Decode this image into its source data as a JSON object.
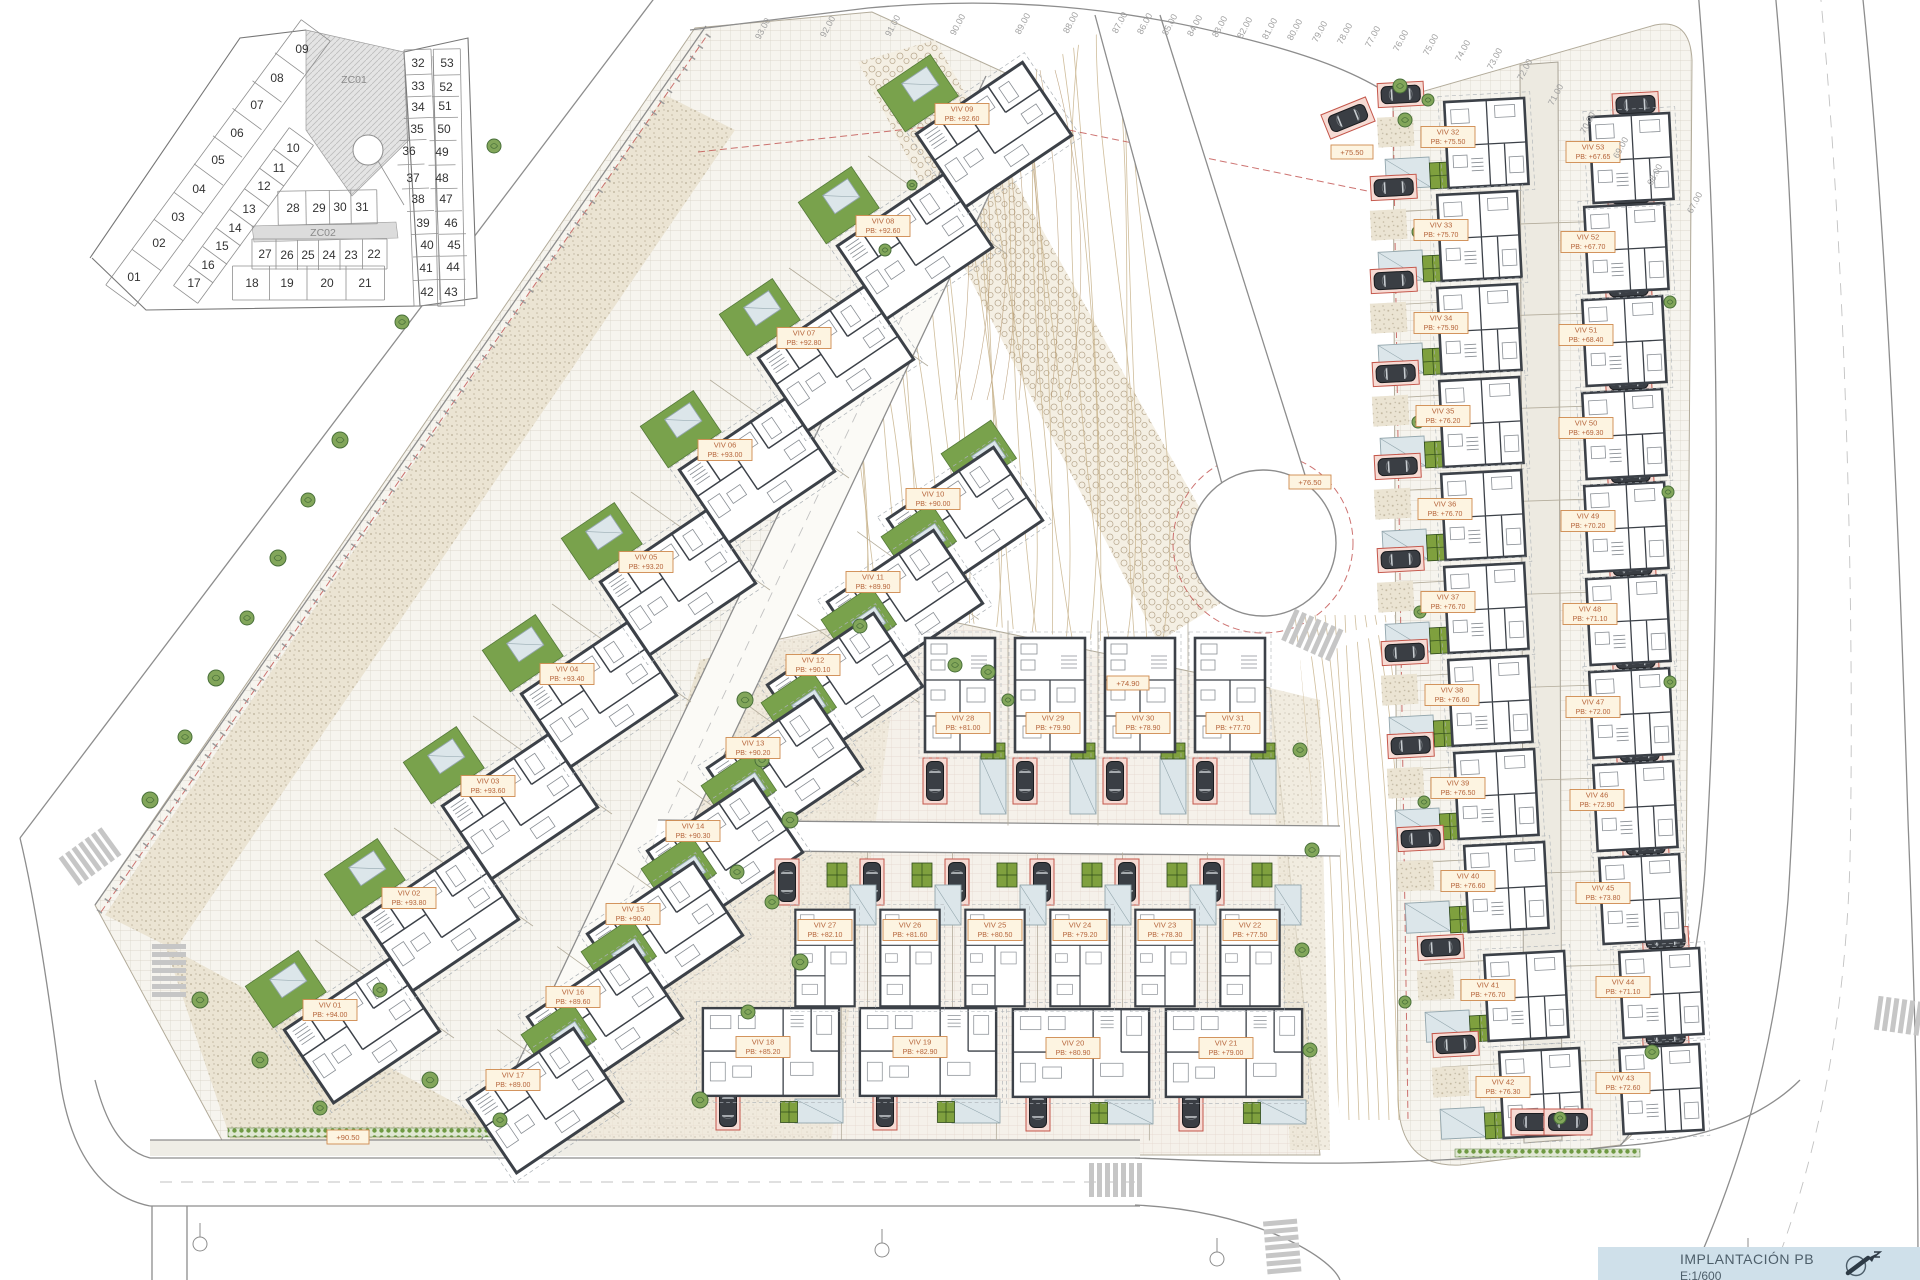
{
  "title_block": {
    "title": "IMPLANTACIÓN PB",
    "scale": "E:1/600"
  },
  "keyplan": {
    "zones": [
      {
        "label": "ZC01",
        "x": 354,
        "y": 83
      },
      {
        "label": "ZC02",
        "x": 323,
        "y": 236
      }
    ],
    "plots": [
      {
        "n": "01",
        "x": 134,
        "y": 281
      },
      {
        "n": "02",
        "x": 159,
        "y": 247
      },
      {
        "n": "03",
        "x": 178,
        "y": 221
      },
      {
        "n": "04",
        "x": 199,
        "y": 193
      },
      {
        "n": "05",
        "x": 218,
        "y": 164
      },
      {
        "n": "06",
        "x": 237,
        "y": 137
      },
      {
        "n": "07",
        "x": 257,
        "y": 109
      },
      {
        "n": "08",
        "x": 277,
        "y": 82
      },
      {
        "n": "09",
        "x": 302,
        "y": 53
      },
      {
        "n": "10",
        "x": 293,
        "y": 152
      },
      {
        "n": "11",
        "x": 279,
        "y": 172
      },
      {
        "n": "12",
        "x": 264,
        "y": 190
      },
      {
        "n": "13",
        "x": 249,
        "y": 213
      },
      {
        "n": "14",
        "x": 235,
        "y": 232
      },
      {
        "n": "15",
        "x": 222,
        "y": 250
      },
      {
        "n": "16",
        "x": 208,
        "y": 269
      },
      {
        "n": "17",
        "x": 194,
        "y": 287
      },
      {
        "n": "18",
        "x": 252,
        "y": 287
      },
      {
        "n": "19",
        "x": 287,
        "y": 287
      },
      {
        "n": "20",
        "x": 327,
        "y": 287
      },
      {
        "n": "21",
        "x": 365,
        "y": 287
      },
      {
        "n": "22",
        "x": 374,
        "y": 258
      },
      {
        "n": "23",
        "x": 351,
        "y": 259
      },
      {
        "n": "24",
        "x": 329,
        "y": 259
      },
      {
        "n": "25",
        "x": 308,
        "y": 259
      },
      {
        "n": "26",
        "x": 287,
        "y": 259
      },
      {
        "n": "27",
        "x": 265,
        "y": 258
      },
      {
        "n": "28",
        "x": 293,
        "y": 212
      },
      {
        "n": "29",
        "x": 319,
        "y": 212
      },
      {
        "n": "30",
        "x": 340,
        "y": 211
      },
      {
        "n": "31",
        "x": 362,
        "y": 211
      },
      {
        "n": "32",
        "x": 418,
        "y": 67
      },
      {
        "n": "33",
        "x": 418,
        "y": 90
      },
      {
        "n": "34",
        "x": 418,
        "y": 111
      },
      {
        "n": "35",
        "x": 417,
        "y": 133
      },
      {
        "n": "36",
        "x": 409,
        "y": 155
      },
      {
        "n": "37",
        "x": 413,
        "y": 182
      },
      {
        "n": "38",
        "x": 418,
        "y": 203
      },
      {
        "n": "39",
        "x": 423,
        "y": 227
      },
      {
        "n": "40",
        "x": 427,
        "y": 249
      },
      {
        "n": "41",
        "x": 426,
        "y": 272
      },
      {
        "n": "42",
        "x": 427,
        "y": 296
      },
      {
        "n": "43",
        "x": 451,
        "y": 296
      },
      {
        "n": "44",
        "x": 453,
        "y": 271
      },
      {
        "n": "45",
        "x": 454,
        "y": 249
      },
      {
        "n": "46",
        "x": 451,
        "y": 227
      },
      {
        "n": "47",
        "x": 446,
        "y": 203
      },
      {
        "n": "48",
        "x": 442,
        "y": 182
      },
      {
        "n": "49",
        "x": 442,
        "y": 156
      },
      {
        "n": "50",
        "x": 444,
        "y": 133
      },
      {
        "n": "51",
        "x": 445,
        "y": 110
      },
      {
        "n": "52",
        "x": 446,
        "y": 91
      },
      {
        "n": "53",
        "x": 447,
        "y": 67
      }
    ],
    "strips": [
      {
        "nums": [
          "01",
          "02",
          "03",
          "04",
          "05",
          "06",
          "07",
          "08",
          "09"
        ],
        "w": 36
      },
      {
        "nums": [
          "10",
          "11",
          "12",
          "13",
          "14",
          "15",
          "16",
          "17"
        ],
        "w": 30
      },
      {
        "nums": [
          "18",
          "19",
          "20",
          "21"
        ],
        "w": 34
      },
      {
        "nums": [
          "27",
          "26",
          "25",
          "24",
          "23",
          "22"
        ],
        "w": 30
      },
      {
        "nums": [
          "28",
          "29",
          "30",
          "31"
        ],
        "w": 34
      },
      {
        "nums": [
          "32",
          "33",
          "34",
          "35",
          "36",
          "37",
          "38",
          "39",
          "40",
          "41",
          "42"
        ],
        "w": 27
      },
      {
        "nums": [
          "53",
          "52",
          "51",
          "50",
          "49",
          "48",
          "47",
          "46",
          "45",
          "44",
          "43"
        ],
        "w": 27
      }
    ]
  },
  "site": {
    "villas": [
      {
        "id": "VIV 01",
        "pb": "PB: +94.00",
        "x": 330,
        "y": 1010,
        "t": "A"
      },
      {
        "id": "VIV 02",
        "pb": "PB: +93.80",
        "x": 409,
        "y": 898,
        "t": "A"
      },
      {
        "id": "VIV 03",
        "pb": "PB: +93.60",
        "x": 488,
        "y": 786,
        "t": "A"
      },
      {
        "id": "VIV 04",
        "pb": "PB: +93.40",
        "x": 567,
        "y": 674,
        "t": "A"
      },
      {
        "id": "VIV 05",
        "pb": "PB: +93.20",
        "x": 646,
        "y": 562,
        "t": "A"
      },
      {
        "id": "VIV 06",
        "pb": "PB: +93.00",
        "x": 725,
        "y": 450,
        "t": "A"
      },
      {
        "id": "VIV 07",
        "pb": "PB: +92.80",
        "x": 804,
        "y": 338,
        "t": "A"
      },
      {
        "id": "VIV 08",
        "pb": "PB: +92.60",
        "x": 883,
        "y": 226,
        "t": "A"
      },
      {
        "id": "VIV 09",
        "pb": "PB: +92.60",
        "x": 962,
        "y": 114,
        "t": "A"
      },
      {
        "id": "VIV 10",
        "pb": "PB: +90.00",
        "x": 933,
        "y": 499,
        "t": "A2"
      },
      {
        "id": "VIV 11",
        "pb": "PB: +89.90",
        "x": 873,
        "y": 582,
        "t": "A2"
      },
      {
        "id": "VIV 12",
        "pb": "PB: +90.10",
        "x": 813,
        "y": 665,
        "t": "A2"
      },
      {
        "id": "VIV 13",
        "pb": "PB: +90.20",
        "x": 753,
        "y": 748,
        "t": "A2"
      },
      {
        "id": "VIV 14",
        "pb": "PB: +90.30",
        "x": 693,
        "y": 831,
        "t": "A2"
      },
      {
        "id": "VIV 15",
        "pb": "PB: +90.40",
        "x": 633,
        "y": 914,
        "t": "A2"
      },
      {
        "id": "VIV 16",
        "pb": "PB: +89.60",
        "x": 573,
        "y": 997,
        "t": "A2"
      },
      {
        "id": "VIV 17",
        "pb": "PB: +89.00",
        "x": 513,
        "y": 1080,
        "t": "A2"
      },
      {
        "id": "VIV 18",
        "pb": "PB: +85.20",
        "x": 763,
        "y": 1047,
        "t": "D"
      },
      {
        "id": "VIV 19",
        "pb": "PB: +82.90",
        "x": 920,
        "y": 1047,
        "t": "D"
      },
      {
        "id": "VIV 20",
        "pb": "PB: +80.90",
        "x": 1073,
        "y": 1048,
        "t": "D"
      },
      {
        "id": "VIV 21",
        "pb": "PB: +79.00",
        "x": 1226,
        "y": 1048,
        "t": "D"
      },
      {
        "id": "VIV 22",
        "pb": "PB: +77.50",
        "x": 1250,
        "y": 930,
        "t": "B2"
      },
      {
        "id": "VIV 23",
        "pb": "PB: +78.30",
        "x": 1165,
        "y": 930,
        "t": "B2"
      },
      {
        "id": "VIV 24",
        "pb": "PB: +79.20",
        "x": 1080,
        "y": 930,
        "t": "B2"
      },
      {
        "id": "VIV 25",
        "pb": "PB: +80.50",
        "x": 995,
        "y": 930,
        "t": "B2"
      },
      {
        "id": "VIV 26",
        "pb": "PB: +81.60",
        "x": 910,
        "y": 930,
        "t": "B2"
      },
      {
        "id": "VIV 27",
        "pb": "PB: +82.10",
        "x": 825,
        "y": 930,
        "t": "B2"
      },
      {
        "id": "VIV 28",
        "pb": "PB: +81.00",
        "x": 963,
        "y": 723,
        "t": "B"
      },
      {
        "id": "VIV 29",
        "pb": "PB: +79.90",
        "x": 1053,
        "y": 723,
        "t": "B"
      },
      {
        "id": "VIV 30",
        "pb": "PB: +78.90",
        "x": 1143,
        "y": 723,
        "t": "B"
      },
      {
        "id": "VIV 31",
        "pb": "PB: +77.70",
        "x": 1233,
        "y": 723,
        "t": "B"
      },
      {
        "id": "VIV 32",
        "pb": "PB: +75.50",
        "x": 1448,
        "y": 137,
        "t": "C",
        "s": "L"
      },
      {
        "id": "VIV 33",
        "pb": "PB: +75.70",
        "x": 1441,
        "y": 230,
        "t": "C",
        "s": "L"
      },
      {
        "id": "VIV 34",
        "pb": "PB: +75.90",
        "x": 1441,
        "y": 323,
        "t": "C",
        "s": "L"
      },
      {
        "id": "VIV 35",
        "pb": "PB: +76.20",
        "x": 1443,
        "y": 416,
        "t": "C",
        "s": "L"
      },
      {
        "id": "VIV 36",
        "pb": "PB: +76.70",
        "x": 1445,
        "y": 509,
        "t": "C",
        "s": "L"
      },
      {
        "id": "VIV 37",
        "pb": "PB: +76.70",
        "x": 1448,
        "y": 602,
        "t": "C",
        "s": "L"
      },
      {
        "id": "VIV 38",
        "pb": "PB: +76.60",
        "x": 1452,
        "y": 695,
        "t": "C",
        "s": "L"
      },
      {
        "id": "VIV 39",
        "pb": "PB: +76.50",
        "x": 1458,
        "y": 788,
        "t": "C",
        "s": "L"
      },
      {
        "id": "VIV 40",
        "pb": "PB: +76.60",
        "x": 1468,
        "y": 881,
        "t": "C",
        "s": "L"
      },
      {
        "id": "VIV 41",
        "pb": "PB: +76.70",
        "x": 1488,
        "y": 990,
        "t": "C",
        "s": "L"
      },
      {
        "id": "VIV 42",
        "pb": "PB: +76.30",
        "x": 1503,
        "y": 1087,
        "t": "C",
        "s": "L"
      },
      {
        "id": "VIV 43",
        "pb": "PB: +72.60",
        "x": 1623,
        "y": 1083,
        "t": "C",
        "s": "R"
      },
      {
        "id": "VIV 44",
        "pb": "PB: +71.10",
        "x": 1623,
        "y": 987,
        "t": "C",
        "s": "R"
      },
      {
        "id": "VIV 45",
        "pb": "PB: +73.80",
        "x": 1603,
        "y": 893,
        "t": "C",
        "s": "R"
      },
      {
        "id": "VIV 46",
        "pb": "PB: +72.90",
        "x": 1597,
        "y": 800,
        "t": "C",
        "s": "R"
      },
      {
        "id": "VIV 47",
        "pb": "PB: +72.00",
        "x": 1593,
        "y": 707,
        "t": "C",
        "s": "R"
      },
      {
        "id": "VIV 48",
        "pb": "PB: +71.10",
        "x": 1590,
        "y": 614,
        "t": "C",
        "s": "R"
      },
      {
        "id": "VIV 49",
        "pb": "PB: +70.20",
        "x": 1588,
        "y": 521,
        "t": "C",
        "s": "R"
      },
      {
        "id": "VIV 50",
        "pb": "PB: +69.30",
        "x": 1586,
        "y": 428,
        "t": "C",
        "s": "R"
      },
      {
        "id": "VIV 51",
        "pb": "PB: +68.40",
        "x": 1586,
        "y": 335,
        "t": "C",
        "s": "R"
      },
      {
        "id": "VIV 52",
        "pb": "PB: +67.70",
        "x": 1588,
        "y": 242,
        "t": "C",
        "s": "R"
      },
      {
        "id": "VIV 53",
        "pb": "PB: +67.65",
        "x": 1593,
        "y": 152,
        "t": "C",
        "s": "R"
      }
    ],
    "spot_levels": [
      {
        "t": "+90.50",
        "x": 348,
        "y": 1137
      },
      {
        "t": "+76.50",
        "x": 1310,
        "y": 482
      },
      {
        "t": "+75.50",
        "x": 1352,
        "y": 152
      },
      {
        "t": "+74.90",
        "x": 1128,
        "y": 683
      }
    ],
    "elevation_labels": [
      {
        "t": "93.00",
        "x": 760,
        "y": 14
      },
      {
        "t": "92.00",
        "x": 825,
        "y": 12
      },
      {
        "t": "91.00",
        "x": 890,
        "y": 11
      },
      {
        "t": "90.00",
        "x": 955,
        "y": 10
      },
      {
        "t": "89.00",
        "x": 1020,
        "y": 9
      },
      {
        "t": "88.00",
        "x": 1068,
        "y": 8
      },
      {
        "t": "87.00",
        "x": 1117,
        "y": 8
      },
      {
        "t": "86.00",
        "x": 1142,
        "y": 9
      },
      {
        "t": "85.00",
        "x": 1167,
        "y": 10
      },
      {
        "t": "84.00",
        "x": 1192,
        "y": 11
      },
      {
        "t": "83.00",
        "x": 1217,
        "y": 12
      },
      {
        "t": "82.00",
        "x": 1242,
        "y": 13
      },
      {
        "t": "81.00",
        "x": 1267,
        "y": 14
      },
      {
        "t": "80.00",
        "x": 1292,
        "y": 15
      },
      {
        "t": "79.00",
        "x": 1317,
        "y": 17
      },
      {
        "t": "78.00",
        "x": 1342,
        "y": 19
      },
      {
        "t": "77.00",
        "x": 1370,
        "y": 22
      },
      {
        "t": "76.00",
        "x": 1398,
        "y": 26
      },
      {
        "t": "75.00",
        "x": 1428,
        "y": 30
      },
      {
        "t": "74.00",
        "x": 1460,
        "y": 36
      },
      {
        "t": "73.00",
        "x": 1492,
        "y": 44
      },
      {
        "t": "72.00",
        "x": 1522,
        "y": 55
      },
      {
        "t": "71.00",
        "x": 1553,
        "y": 80
      },
      {
        "t": "70.00",
        "x": 1585,
        "y": 108
      },
      {
        "t": "69.00",
        "x": 1618,
        "y": 133
      },
      {
        "t": "68.00",
        "x": 1652,
        "y": 160
      },
      {
        "t": "67.00",
        "x": 1692,
        "y": 188
      }
    ],
    "trees": [
      [
        150,
        800,
        8
      ],
      [
        185,
        737,
        7
      ],
      [
        216,
        678,
        8
      ],
      [
        247,
        618,
        7
      ],
      [
        278,
        558,
        8
      ],
      [
        308,
        500,
        7
      ],
      [
        340,
        440,
        8
      ],
      [
        402,
        322,
        7
      ],
      [
        432,
        262,
        8
      ],
      [
        494,
        146,
        7
      ],
      [
        200,
        1000,
        8
      ],
      [
        260,
        1060,
        8
      ],
      [
        320,
        1108,
        7
      ],
      [
        430,
        1080,
        8
      ],
      [
        500,
        1120,
        7
      ],
      [
        380,
        990,
        7
      ],
      [
        745,
        700,
        8
      ],
      [
        762,
        760,
        7
      ],
      [
        790,
        820,
        8
      ],
      [
        737,
        872,
        7
      ],
      [
        772,
        902,
        7
      ],
      [
        800,
        962,
        8
      ],
      [
        748,
        1012,
        7
      ],
      [
        700,
        1100,
        8
      ],
      [
        955,
        665,
        7
      ],
      [
        988,
        672,
        7
      ],
      [
        1008,
        700,
        6
      ],
      [
        860,
        626,
        7
      ],
      [
        1300,
        750,
        7
      ],
      [
        1312,
        850,
        7
      ],
      [
        1302,
        950,
        7
      ],
      [
        1310,
        1050,
        7
      ],
      [
        885,
        250,
        6
      ],
      [
        912,
        185,
        5
      ],
      [
        1405,
        120,
        7
      ],
      [
        1418,
        232,
        6
      ],
      [
        1418,
        422,
        6
      ],
      [
        1420,
        612,
        6
      ],
      [
        1424,
        802,
        6
      ],
      [
        1670,
        302,
        6
      ],
      [
        1668,
        492,
        6
      ],
      [
        1670,
        682,
        6
      ],
      [
        1405,
        1002,
        6
      ],
      [
        1652,
        1052,
        7
      ],
      [
        1560,
        1118,
        6
      ],
      [
        1400,
        86,
        7
      ],
      [
        1428,
        100,
        6
      ]
    ],
    "extra_cars": [
      [
        1535,
        1122,
        90
      ],
      [
        1568,
        1122,
        90
      ],
      [
        1348,
        118,
        68
      ]
    ],
    "crosswalks": [
      [
        88,
        858,
        -36
      ],
      [
        169,
        968,
        90
      ],
      [
        1113,
        1180,
        0
      ],
      [
        1310,
        634,
        24
      ],
      [
        1282,
        1244,
        85
      ],
      [
        1900,
        1016,
        8
      ]
    ],
    "hedges": [
      [
        228,
        1128,
        320,
        9
      ],
      [
        1455,
        1149,
        185,
        8
      ]
    ],
    "section_markers": [
      [
        200,
        1237
      ],
      [
        882,
        1243
      ],
      [
        1217,
        1252
      ],
      [
        1748,
        1252
      ]
    ]
  }
}
